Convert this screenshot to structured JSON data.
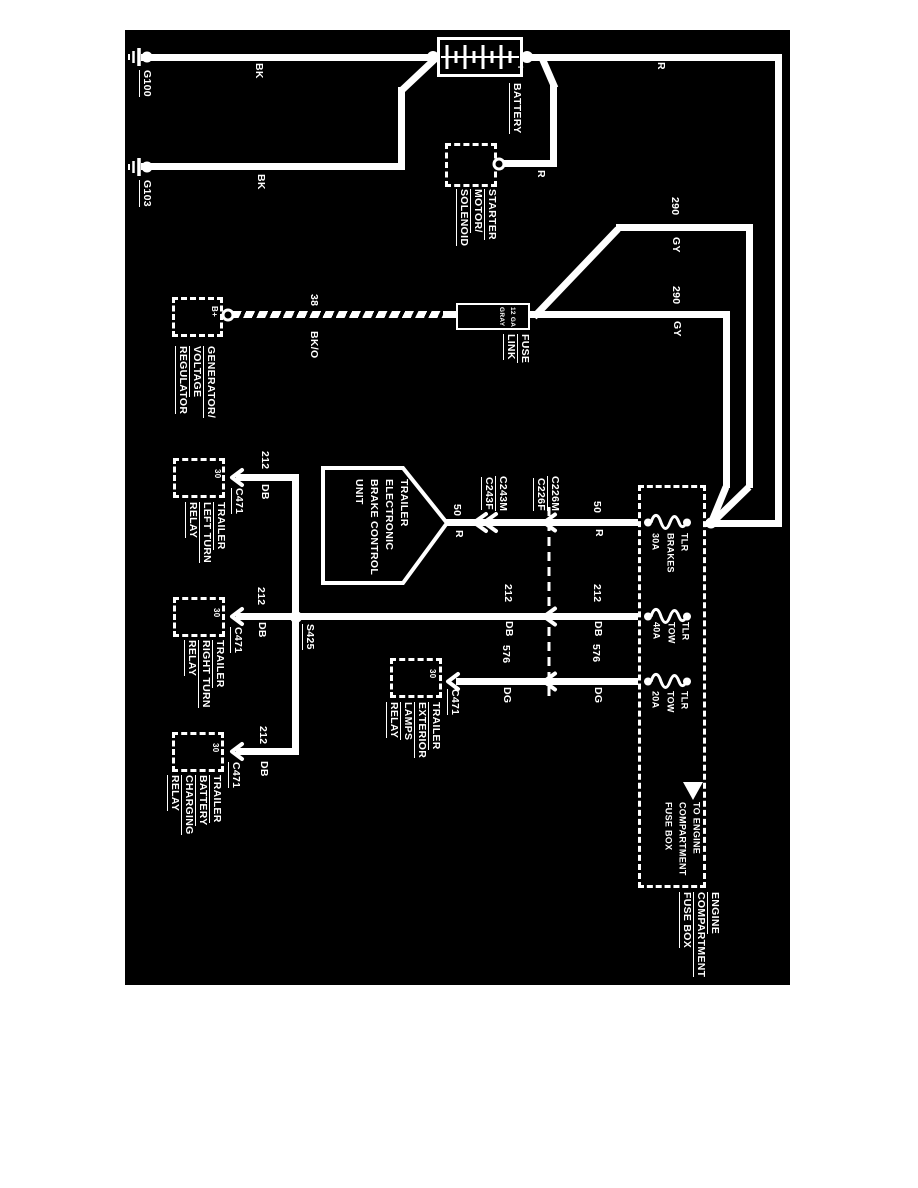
{
  "colors": {
    "page_background": "#ffffff",
    "diagram_background": "#000000",
    "line": "#ffffff"
  },
  "grounds": {
    "g100": "G100",
    "g103": "G103"
  },
  "battery": {
    "name": "BATTERY",
    "plus": "+"
  },
  "starter": {
    "lines": [
      "STARTER",
      "MOTOR/",
      "SOLENOID"
    ]
  },
  "generator": {
    "lines": [
      "GENERATOR/",
      "VOLTAGE",
      "REGULATOR"
    ],
    "terminal": "B+"
  },
  "fuse_link": {
    "gauge_lines": [
      "12 GA",
      "GRAY"
    ],
    "label_lines": [
      "FUSE",
      "LINK"
    ]
  },
  "bcu": {
    "lines": [
      "TRAILER",
      "ELECTRONIC",
      "BRAKE CONTROL",
      "UNIT"
    ]
  },
  "connectors": {
    "c243m": "C243M",
    "c243f": "C243F",
    "c226m": "C226M",
    "c226f": "C226F",
    "c471": "C471"
  },
  "splices": {
    "s425": "S425"
  },
  "wires": {
    "bk": "BK",
    "r": "R",
    "gen_gauge": "38",
    "gen_color": "BK/O",
    "gy_circuit": "290",
    "gy_color": "GY",
    "c50": "50",
    "c50_color": "R",
    "c212": "212",
    "c212_color": "DB",
    "c576": "576",
    "c576_color": "DG"
  },
  "relays": {
    "left_turn": {
      "lines": [
        "TRAILER",
        "LEFT TURN",
        "RELAY"
      ],
      "terminal": "30"
    },
    "right_turn": {
      "lines": [
        "TRAILER",
        "RIGHT TURN",
        "RELAY"
      ],
      "terminal": "30"
    },
    "battery_charging": {
      "lines": [
        "TRAILER",
        "BATTERY",
        "CHARGING",
        "RELAY"
      ],
      "terminal": "30"
    },
    "exterior_lamps": {
      "lines": [
        "TRAILER",
        "EXTERIOR",
        "LAMPS",
        "RELAY"
      ],
      "terminal": "30"
    }
  },
  "fuse_box": {
    "fuses": [
      {
        "name_lines": [
          "TLR",
          "BRAKES"
        ],
        "rating": "30A"
      },
      {
        "name_lines": [
          "TLR",
          "TOW"
        ],
        "rating": "40A"
      },
      {
        "name_lines": [
          "TLR",
          "TOW"
        ],
        "rating": "20A"
      }
    ],
    "arrow_note_lines": [
      "TO ENGINE",
      "COMPARTMENT",
      "FUSE BOX"
    ],
    "title_lines": [
      "ENGINE",
      "COMPARTMENT",
      "FUSE BOX"
    ]
  }
}
